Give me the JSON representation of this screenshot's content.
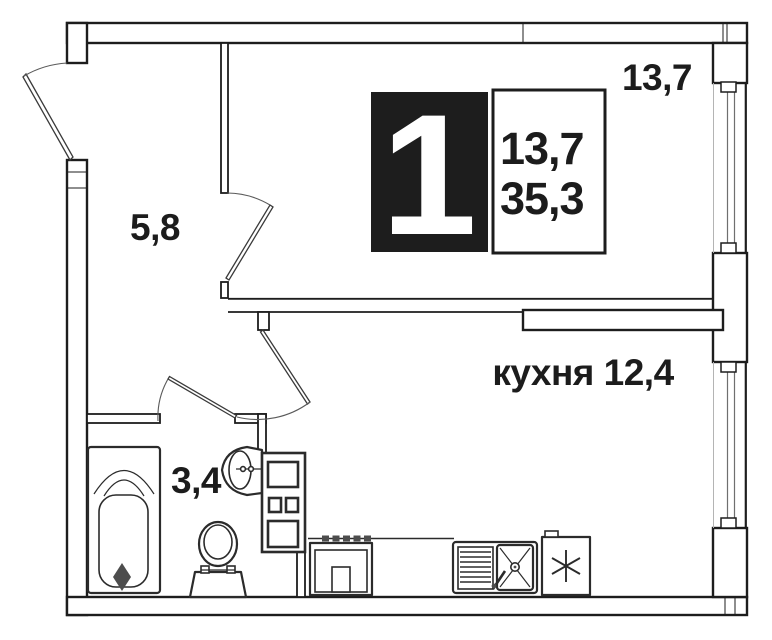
{
  "plan": {
    "badge": {
      "number": "1",
      "room_area": "13,7",
      "total_area": "35,3"
    },
    "labels": {
      "living_room": "13,7",
      "hallway": "5,8",
      "bathroom": "3,4",
      "kitchen": "кухня 12,4"
    },
    "fixtures": [
      "bathtub",
      "toilet",
      "wash-basin",
      "utility-shaft",
      "stove",
      "kitchen-sink",
      "refrigerator"
    ],
    "colors": {
      "line": "#1d1d1d",
      "badge_bg": "#1d1d1d",
      "badge_text": "#ffffff"
    }
  }
}
